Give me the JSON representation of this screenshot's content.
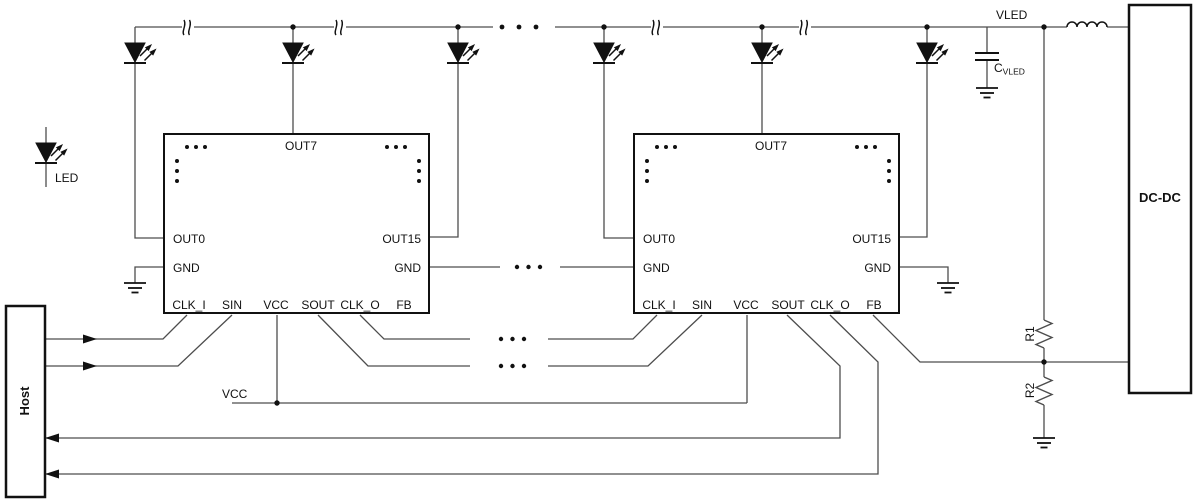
{
  "colors": {
    "wire": "#4d4d4d",
    "ink": "#111111"
  },
  "legend": {
    "label": "LED"
  },
  "blocks": {
    "host": "Host",
    "dcdc": "DC-DC"
  },
  "nets": {
    "vled": "VLED",
    "vcc": "VCC"
  },
  "passives": {
    "r1": "R1",
    "r2": "R2",
    "cap": "C",
    "cap_sub": "VLED"
  },
  "chip1": {
    "out7": "OUT7",
    "out0": "OUT0",
    "out15": "OUT15",
    "gnd_left": "GND",
    "gnd_right": "GND",
    "clk_i": "CLK_I",
    "sin": "SIN",
    "vcc": "VCC",
    "sout": "SOUT",
    "clk_o": "CLK_O",
    "fb": "FB"
  },
  "chip2": {
    "out7": "OUT7",
    "out0": "OUT0",
    "out15": "OUT15",
    "gnd_left": "GND",
    "gnd_right": "GND",
    "clk_i": "CLK_I",
    "sin": "SIN",
    "vcc": "VCC",
    "sout": "SOUT",
    "clk_o": "CLK_O",
    "fb": "FB"
  }
}
